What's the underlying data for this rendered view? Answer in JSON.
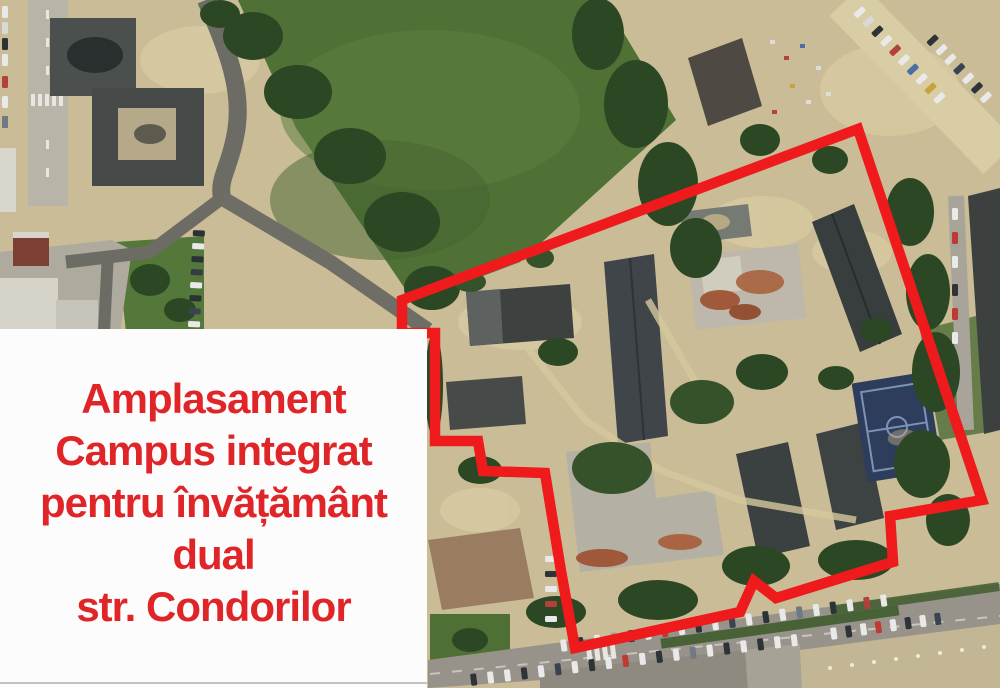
{
  "map": {
    "kind": "aerial-satellite-photo",
    "site_boundary_points": "858,129 982,500 890,516 893,562 776,598 754,581 740,612 575,648 561,571 545,473 483,471 478,441 435,441 435,333 402,333 402,300"
  },
  "label_box": {
    "lines": [
      "Amplasament",
      "Campus integrat",
      "pentru învățământ",
      "dual",
      "str. Condorilor"
    ]
  },
  "colors": {
    "annotation_red": "#ee1a1c",
    "label_text_red": "#e02528",
    "label_box_bg": "#fcfcfc"
  }
}
